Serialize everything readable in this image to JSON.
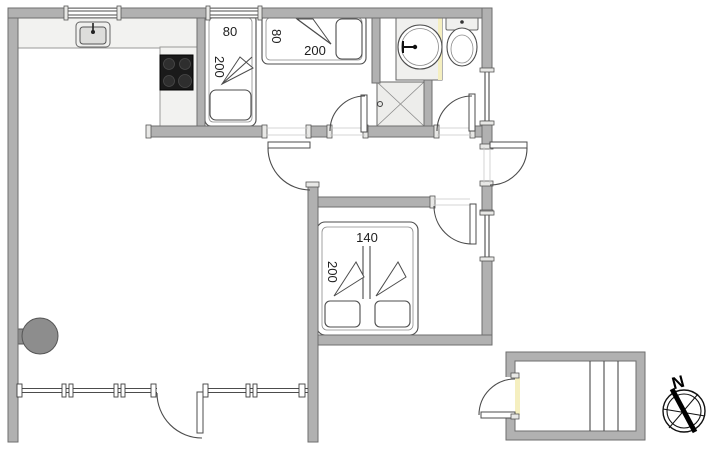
{
  "floorplan": {
    "beds": {
      "single_bed_left": {
        "width_label": "80",
        "length_label": "200"
      },
      "single_bed_top": {
        "width_label": "80",
        "length_label": "200"
      },
      "double_bed": {
        "width_label": "140",
        "length_label": "200"
      }
    },
    "compass": {
      "north_label": "N"
    },
    "colors": {
      "wall": "#b1b1b1",
      "wall_outline": "#6e6e6e",
      "drawing_line": "#4c4c4c",
      "counter": "#f2f2f0",
      "stove_top": "#1a1a1a",
      "burner": "#2e2e2e",
      "wood_stove": "#8d8d8d",
      "accent_yellow": "#f5efc0",
      "background": "#ffffff"
    }
  }
}
